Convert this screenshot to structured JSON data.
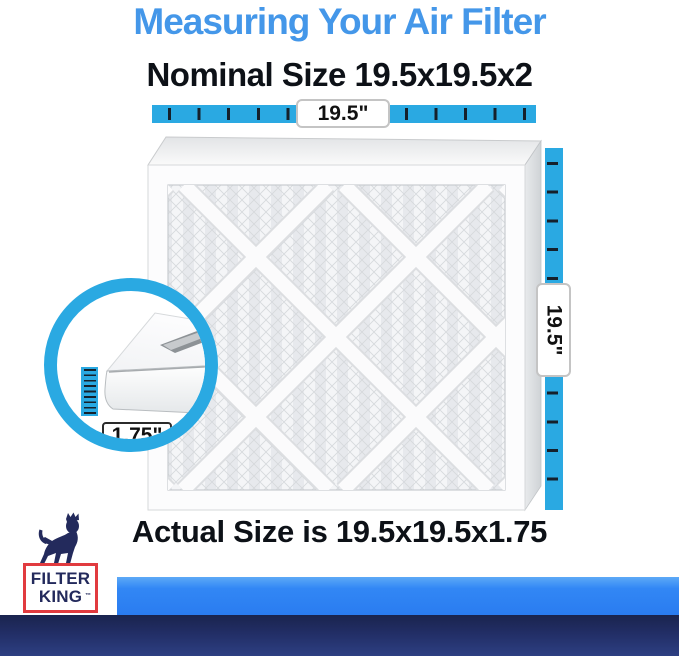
{
  "header": {
    "title": "Measuring Your Air Filter",
    "subtitle": "Nominal Size 19.5x19.5x2"
  },
  "measurements": {
    "width_label": "19.5\"",
    "height_label": "19.5\"",
    "depth_label": "1.75\""
  },
  "footer": {
    "actual_size": "Actual Size is 19.5x19.5x1.75"
  },
  "brand": {
    "line1": "FILTER",
    "line2": "KING",
    "tm": "™"
  },
  "colors": {
    "title_blue": "#4497E9",
    "ruler_blue": "#2AA9E2",
    "tick_dark": "#15202B",
    "bottom_bar_blue": "#2F82F3",
    "bottom_bar_navy": "#232E66",
    "brand_red": "#E13B3F",
    "brand_navy": "#232A5C",
    "heading_black": "#0d1117"
  }
}
